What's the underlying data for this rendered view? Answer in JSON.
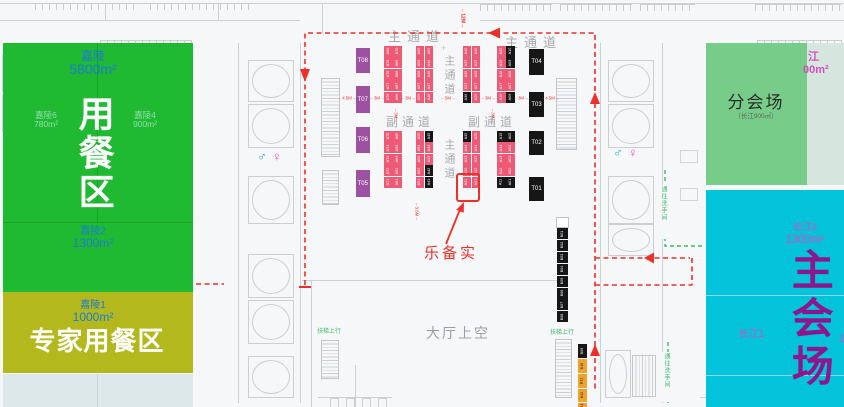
{
  "zones": {
    "dining_area": {
      "hall": "嘉陵",
      "hall_area": "5800m²",
      "vertical_name": "用餐区",
      "room_left": {
        "name": "嘉陵6",
        "area": "780m²"
      },
      "room_right": {
        "name": "嘉陵4",
        "area": "900m²"
      },
      "room_bottom": {
        "name": "嘉陵2",
        "area": "1300m²"
      }
    },
    "expert_dining": {
      "room": "嘉陵1",
      "area": "1000m²",
      "name": "专家用餐区"
    },
    "sub_venue": {
      "name": "分会场",
      "detail": "（长江900㎡）"
    },
    "changjiang_partial": {
      "line1": "江",
      "line2": "00m²"
    },
    "main_venue": {
      "name": "主会场",
      "room_top": {
        "name": "长江2",
        "area": "1300m²"
      },
      "room_mid": {
        "name": "长江1"
      },
      "edge_fragment": "1"
    }
  },
  "aisles": {
    "main": "主通道",
    "sub": "副通道"
  },
  "labels": {
    "hall_void": "大厅上空",
    "highlight_exhibitor": "乐备实",
    "escalator_up": "扶梯上行",
    "to_restroom": "通往洗手间",
    "top_dimension": "←12M→"
  },
  "dimension_markers": [
    "←4.5M→",
    "←3M→",
    "←3M→",
    "←5M→",
    "←3M→",
    "←3M→",
    "←4.5M→"
  ],
  "aisle_width_markers": [
    "←3M→",
    "←3M→",
    "←3.5M→"
  ],
  "booth_strips": [
    {
      "black": [],
      "cols": [
        [
          "A80",
          "A79",
          "A78",
          "A77",
          "A76"
        ],
        [
          "A70",
          "A69",
          "A68",
          "A67",
          "A66"
        ]
      ]
    },
    {
      "black": [],
      "cols": [
        [
          "A60",
          "A59",
          "A58",
          "A57",
          "A56"
        ],
        [
          "A50",
          "A49",
          "A48",
          "A47",
          "A46"
        ]
      ]
    },
    {
      "black": [
        "A36"
      ],
      "cols": [
        [
          "A40",
          "A39",
          "A38",
          "A37",
          "A36"
        ],
        [
          "A30",
          "A29",
          "A28",
          "A27",
          "A26"
        ]
      ]
    },
    {
      "black": [
        "A10",
        "A09",
        "A06"
      ],
      "cols": [
        [
          "A20",
          "A19",
          "A18",
          "A17",
          "A16"
        ],
        [
          "A10",
          "A09",
          "A08",
          "A07",
          "A06"
        ]
      ]
    },
    {
      "black": [],
      "cols": [
        [
          "A75",
          "A74",
          "A73",
          "A72",
          "A71"
        ],
        [
          "A65",
          "A64",
          "A63",
          "A62",
          "A61"
        ]
      ]
    },
    {
      "black": [
        "A45",
        "A42",
        "A41"
      ],
      "cols": [
        [
          "A55",
          "A54",
          "A53",
          "A52",
          "A51"
        ],
        [
          "A45",
          "A44",
          "A43",
          "A42",
          "A41"
        ]
      ]
    },
    {
      "black": [
        "A35"
      ],
      "cols": [
        [
          "A35",
          "A34",
          "A33",
          "A32",
          "A31"
        ],
        [
          "A25",
          "A24",
          "A23",
          "A22",
          "A21"
        ]
      ]
    },
    {
      "black": [
        "A15",
        "A11",
        "A05",
        "A01"
      ],
      "cols": [
        [
          "A15",
          "A14",
          "A13",
          "A12",
          "A11"
        ],
        [
          "A05",
          "A04",
          "A03",
          "A02",
          "A01"
        ]
      ]
    }
  ],
  "highlight_booth": "A31",
  "t_booths": {
    "purple": [
      "T08",
      "T07",
      "T06",
      "T05"
    ],
    "black": [
      "T04",
      "T03",
      "T02",
      "T01"
    ]
  },
  "b_booths": {
    "upper_black": [
      "B01",
      "B02",
      "B03",
      "B04",
      "B05",
      "B06",
      "B07",
      "B08"
    ],
    "lower": [
      {
        "id": "B09",
        "style": "black"
      },
      {
        "id": "B10",
        "style": "orange"
      },
      {
        "id": "B11",
        "style": "orange"
      },
      {
        "id": "B12",
        "style": "orange"
      },
      {
        "id": "B13",
        "style": "orange"
      }
    ]
  },
  "restroom_icons": {
    "male": "♂",
    "female": "♀"
  },
  "colors": {
    "dining_green": "#20b932",
    "expert_olive": "#b3b81d",
    "sub_venue_green": "#77cc8a",
    "main_venue_cyan": "#02c3da",
    "venue_text_magenta": "#d14fc2",
    "main_venue_text": "#8d168d",
    "label_blue": "#1a7cd3",
    "booth_pink": "#ee5a76",
    "booth_black": "#161616",
    "booth_purple": "#9c51a1",
    "booth_orange": "#f0a22e",
    "route_red": "#ee2f28",
    "route_green": "#3cb96a"
  }
}
